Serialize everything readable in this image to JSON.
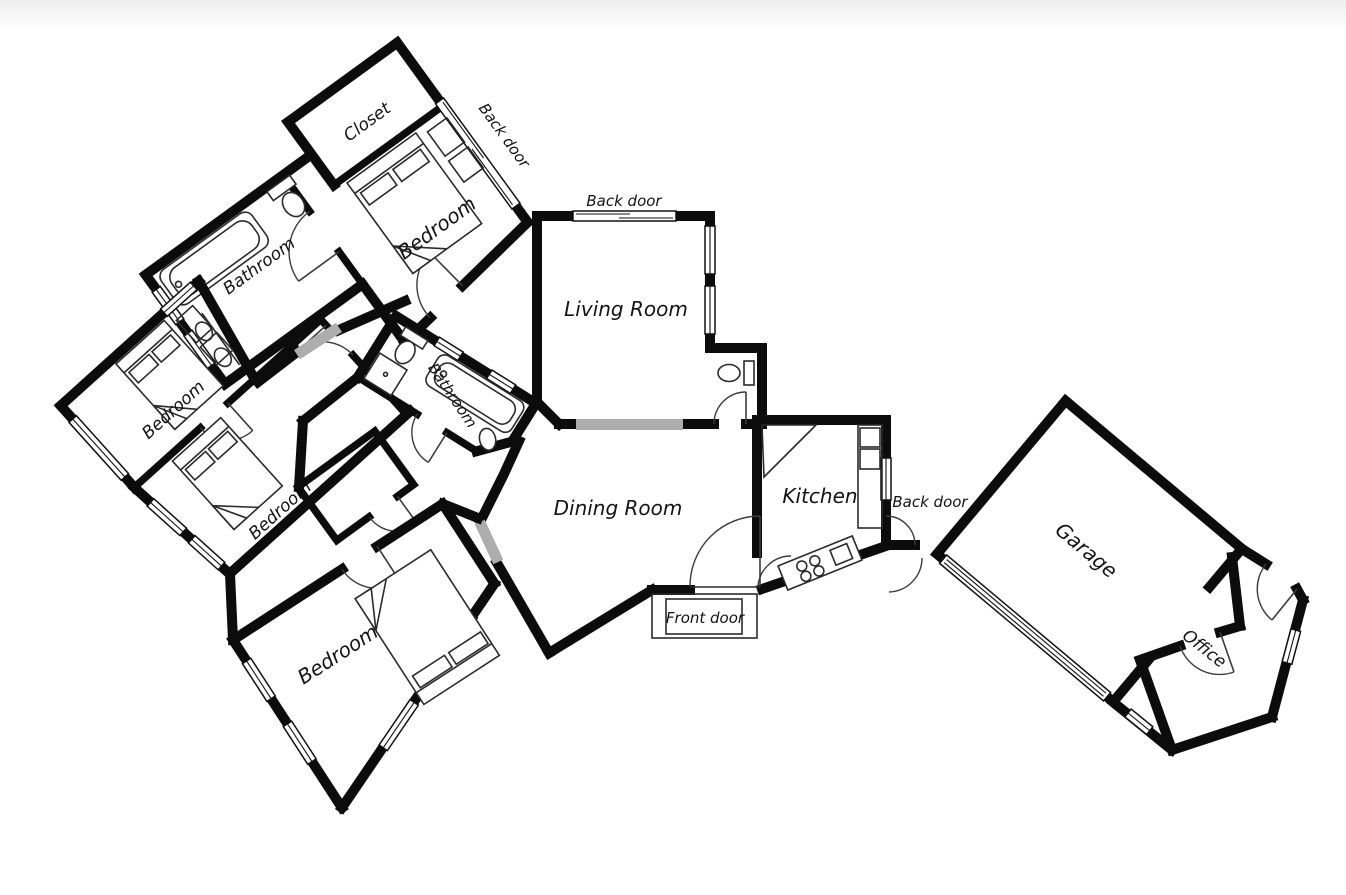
{
  "title": "House floor plan",
  "colors": {
    "wall": "#0c0c0c",
    "passage": "#adadad",
    "background": "#ffffff",
    "text": "#141414"
  },
  "labels": {
    "closet": "Closet",
    "back_door_master": "Back door",
    "bathroom_master": "Bathroom",
    "bedroom_master": "Bedroom",
    "back_door_living": "Back door",
    "living_room": "Living Room",
    "bedroom_left_upper": "Bedroom",
    "bedroom_left_middle": "Bedroom",
    "bathroom_middle": "Bathroom",
    "bedroom_lower": "Bedroom",
    "dining_room": "Dining Room",
    "kitchen": "Kitchen",
    "back_door_kitchen": "Back door",
    "front_door": "Front door",
    "garage": "Garage",
    "office": "Office"
  },
  "icons": [
    "bed-icon",
    "bathtub-icon",
    "toilet-icon",
    "sink-icon",
    "shower-icon",
    "stove-icon",
    "fridge-icon",
    "counter-icon",
    "window",
    "door-arc",
    "passage-opening"
  ]
}
